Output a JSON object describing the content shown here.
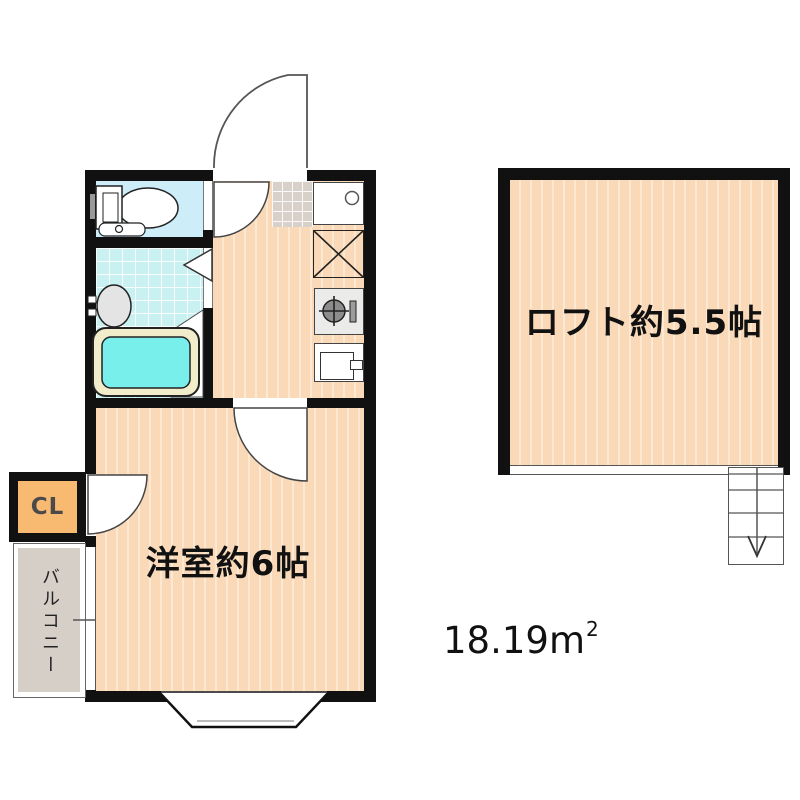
{
  "rooms": {
    "western_room": {
      "label": "洋室約6帖"
    },
    "loft": {
      "label": "ロフト約5.5帖"
    },
    "closet": {
      "label": "CL"
    },
    "balcony": {
      "label": "バルコニー"
    }
  },
  "area": {
    "value": "18.19",
    "unit": "m",
    "superscript": "2"
  },
  "fixtures": {
    "toilet": "toilet",
    "washbasin": "washbasin",
    "bathtub": "bathtub",
    "kitchen_counter_sink": "kitchen-counter",
    "refrigerator_space": "refrigerator-space-x-box",
    "gas_stove": "gas-stove",
    "kitchen_appliance": "kitchen-appliance",
    "entrance_door": "entrance-door-swing",
    "stairs": "stairs-down-arrow",
    "bay_window": "bay-window"
  },
  "colors": {
    "wall": "#111111",
    "floor_wood": "#f9d9b7",
    "toilet_floor": "#cdedf8",
    "bath_floor": "#c9f1f1",
    "bathtub_water": "#79efec",
    "bathtub_rim": "#f1ecca",
    "genkan_tile": "#d8d1ca",
    "balcony": "#d6cfc8",
    "closet": "#f8b971"
  }
}
